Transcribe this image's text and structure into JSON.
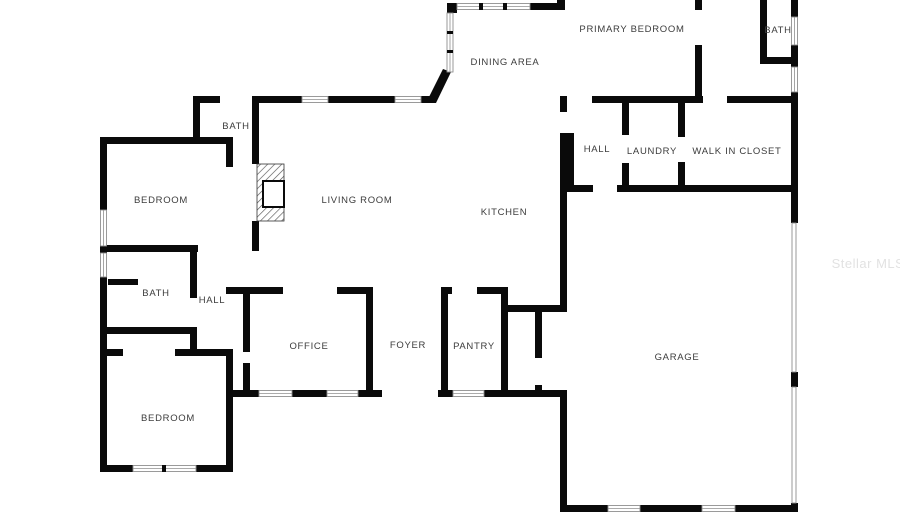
{
  "watermark": "Stellar MLS",
  "rooms": {
    "dining_area": "DINING AREA",
    "primary_bedroom": "PRIMARY BEDROOM",
    "bath_top_right": "BATH",
    "bath_top_left": "BATH",
    "bedroom_upper": "BEDROOM",
    "living_room": "LIVING ROOM",
    "kitchen": "KITCHEN",
    "hall_upper": "HALL",
    "laundry": "LAUNDRY",
    "walk_in_closet": "WALK IN CLOSET",
    "bath_lower": "BATH",
    "hall_lower": "HALL",
    "office": "OFFICE",
    "foyer": "FOYER",
    "pantry": "PANTRY",
    "bedroom_lower": "BEDROOM",
    "garage": "GARAGE"
  },
  "colors": {
    "wall": "#0a0a0a",
    "window_stroke": "#8f8f8f",
    "label": "#3c3c3c",
    "watermark": "#e2e2e2"
  }
}
